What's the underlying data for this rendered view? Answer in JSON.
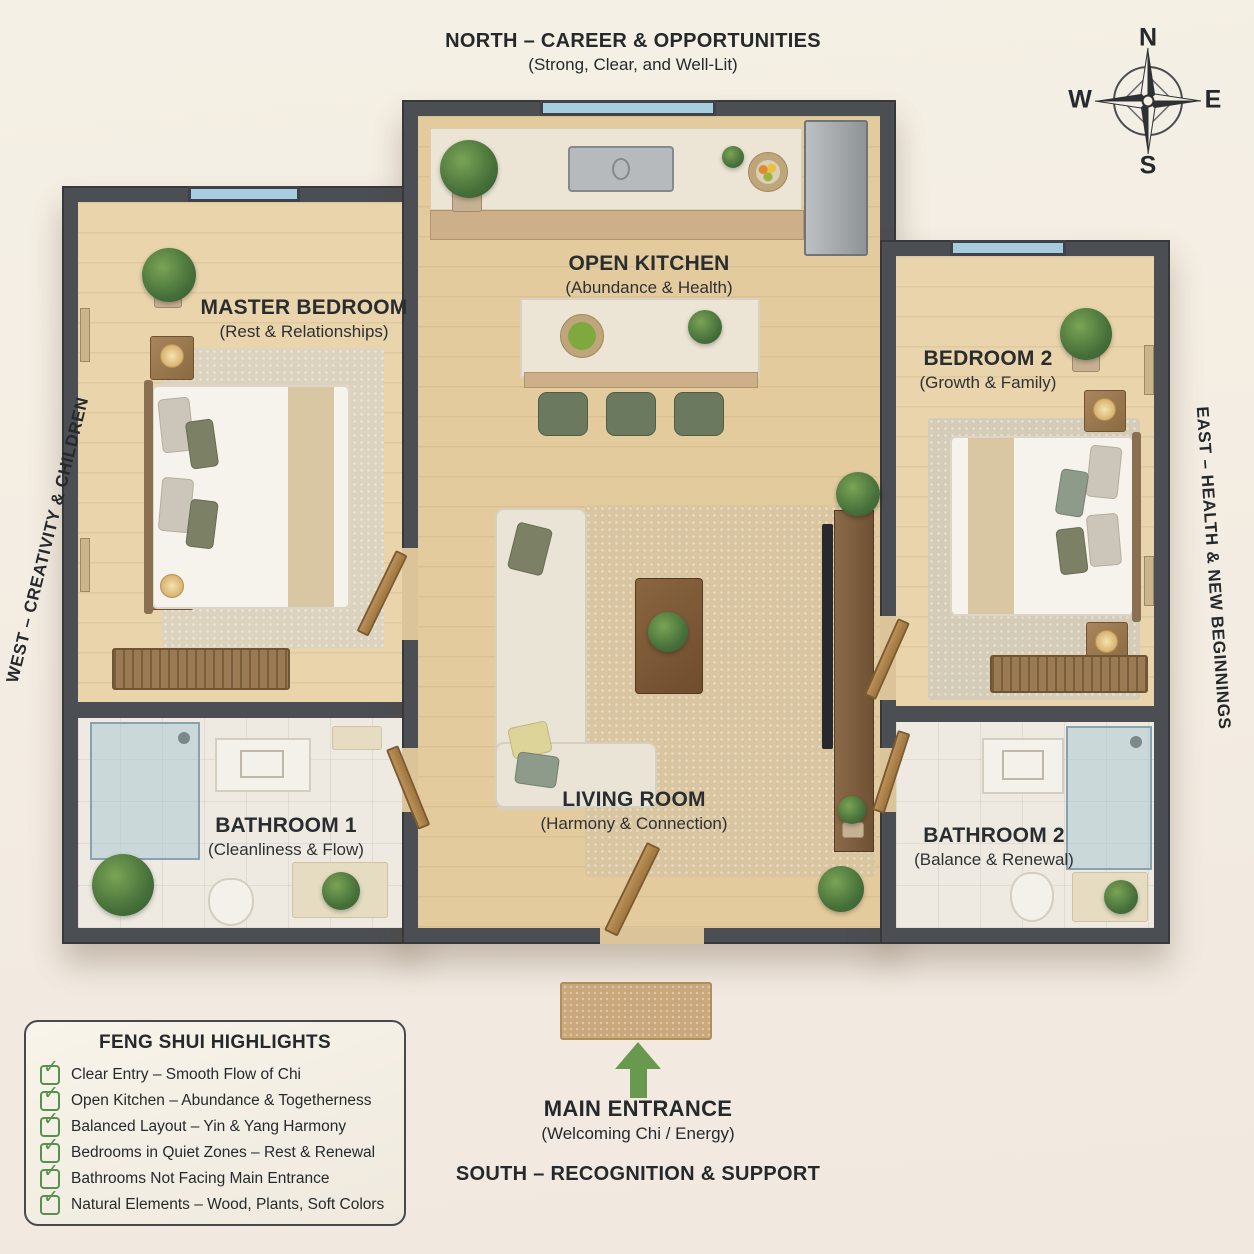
{
  "directions": {
    "north_title": "NORTH – CAREER & OPPORTUNITIES",
    "north_subtitle": "(Strong, Clear, and Well-Lit)",
    "south_title": "SOUTH – RECOGNITION & SUPPORT",
    "west_title": "WEST – CREATIVITY & CHILDREN",
    "east_title": "EAST – HEALTH & NEW BEGINNINGS"
  },
  "compass": {
    "n": "N",
    "e": "E",
    "s": "S",
    "w": "W"
  },
  "entrance": {
    "title": "MAIN ENTRANCE",
    "subtitle": "(Welcoming Chi / Energy)"
  },
  "rooms": {
    "master_bedroom": {
      "name": "MASTER BEDROOM",
      "subtitle": "(Rest & Relationships)"
    },
    "open_kitchen": {
      "name": "OPEN KITCHEN",
      "subtitle": "(Abundance & Health)"
    },
    "bedroom_2": {
      "name": "BEDROOM 2",
      "subtitle": "(Growth & Family)"
    },
    "living_room": {
      "name": "LIVING ROOM",
      "subtitle": "(Harmony & Connection)"
    },
    "bathroom_1": {
      "name": "BATHROOM 1",
      "subtitle": "(Cleanliness & Flow)"
    },
    "bathroom_2": {
      "name": "BATHROOM 2",
      "subtitle": "(Balance & Renewal)"
    }
  },
  "legend": {
    "title": "FENG SHUI HIGHLIGHTS",
    "check_glyph": "✓",
    "items": [
      "Clear Entry – Smooth Flow of Chi",
      "Open Kitchen – Abundance & Togetherness",
      "Balanced Layout – Yin & Yang Harmony",
      "Bedrooms in Quiet Zones – Rest & Renewal",
      "Bathrooms Not Facing Main Entrance",
      "Natural Elements – Wood, Plants, Soft Colors"
    ]
  },
  "colors": {
    "wall": "#4b4e53",
    "wood_floor": "#e4cb9e",
    "tile_floor": "#eeeae1",
    "window_blue": "#a9cde0",
    "door_wood": "#b0854f",
    "accent_green": "#58904e",
    "arrow_green": "#69994f",
    "background_cream": "#f4efe5",
    "text_dark": "#26292c"
  }
}
